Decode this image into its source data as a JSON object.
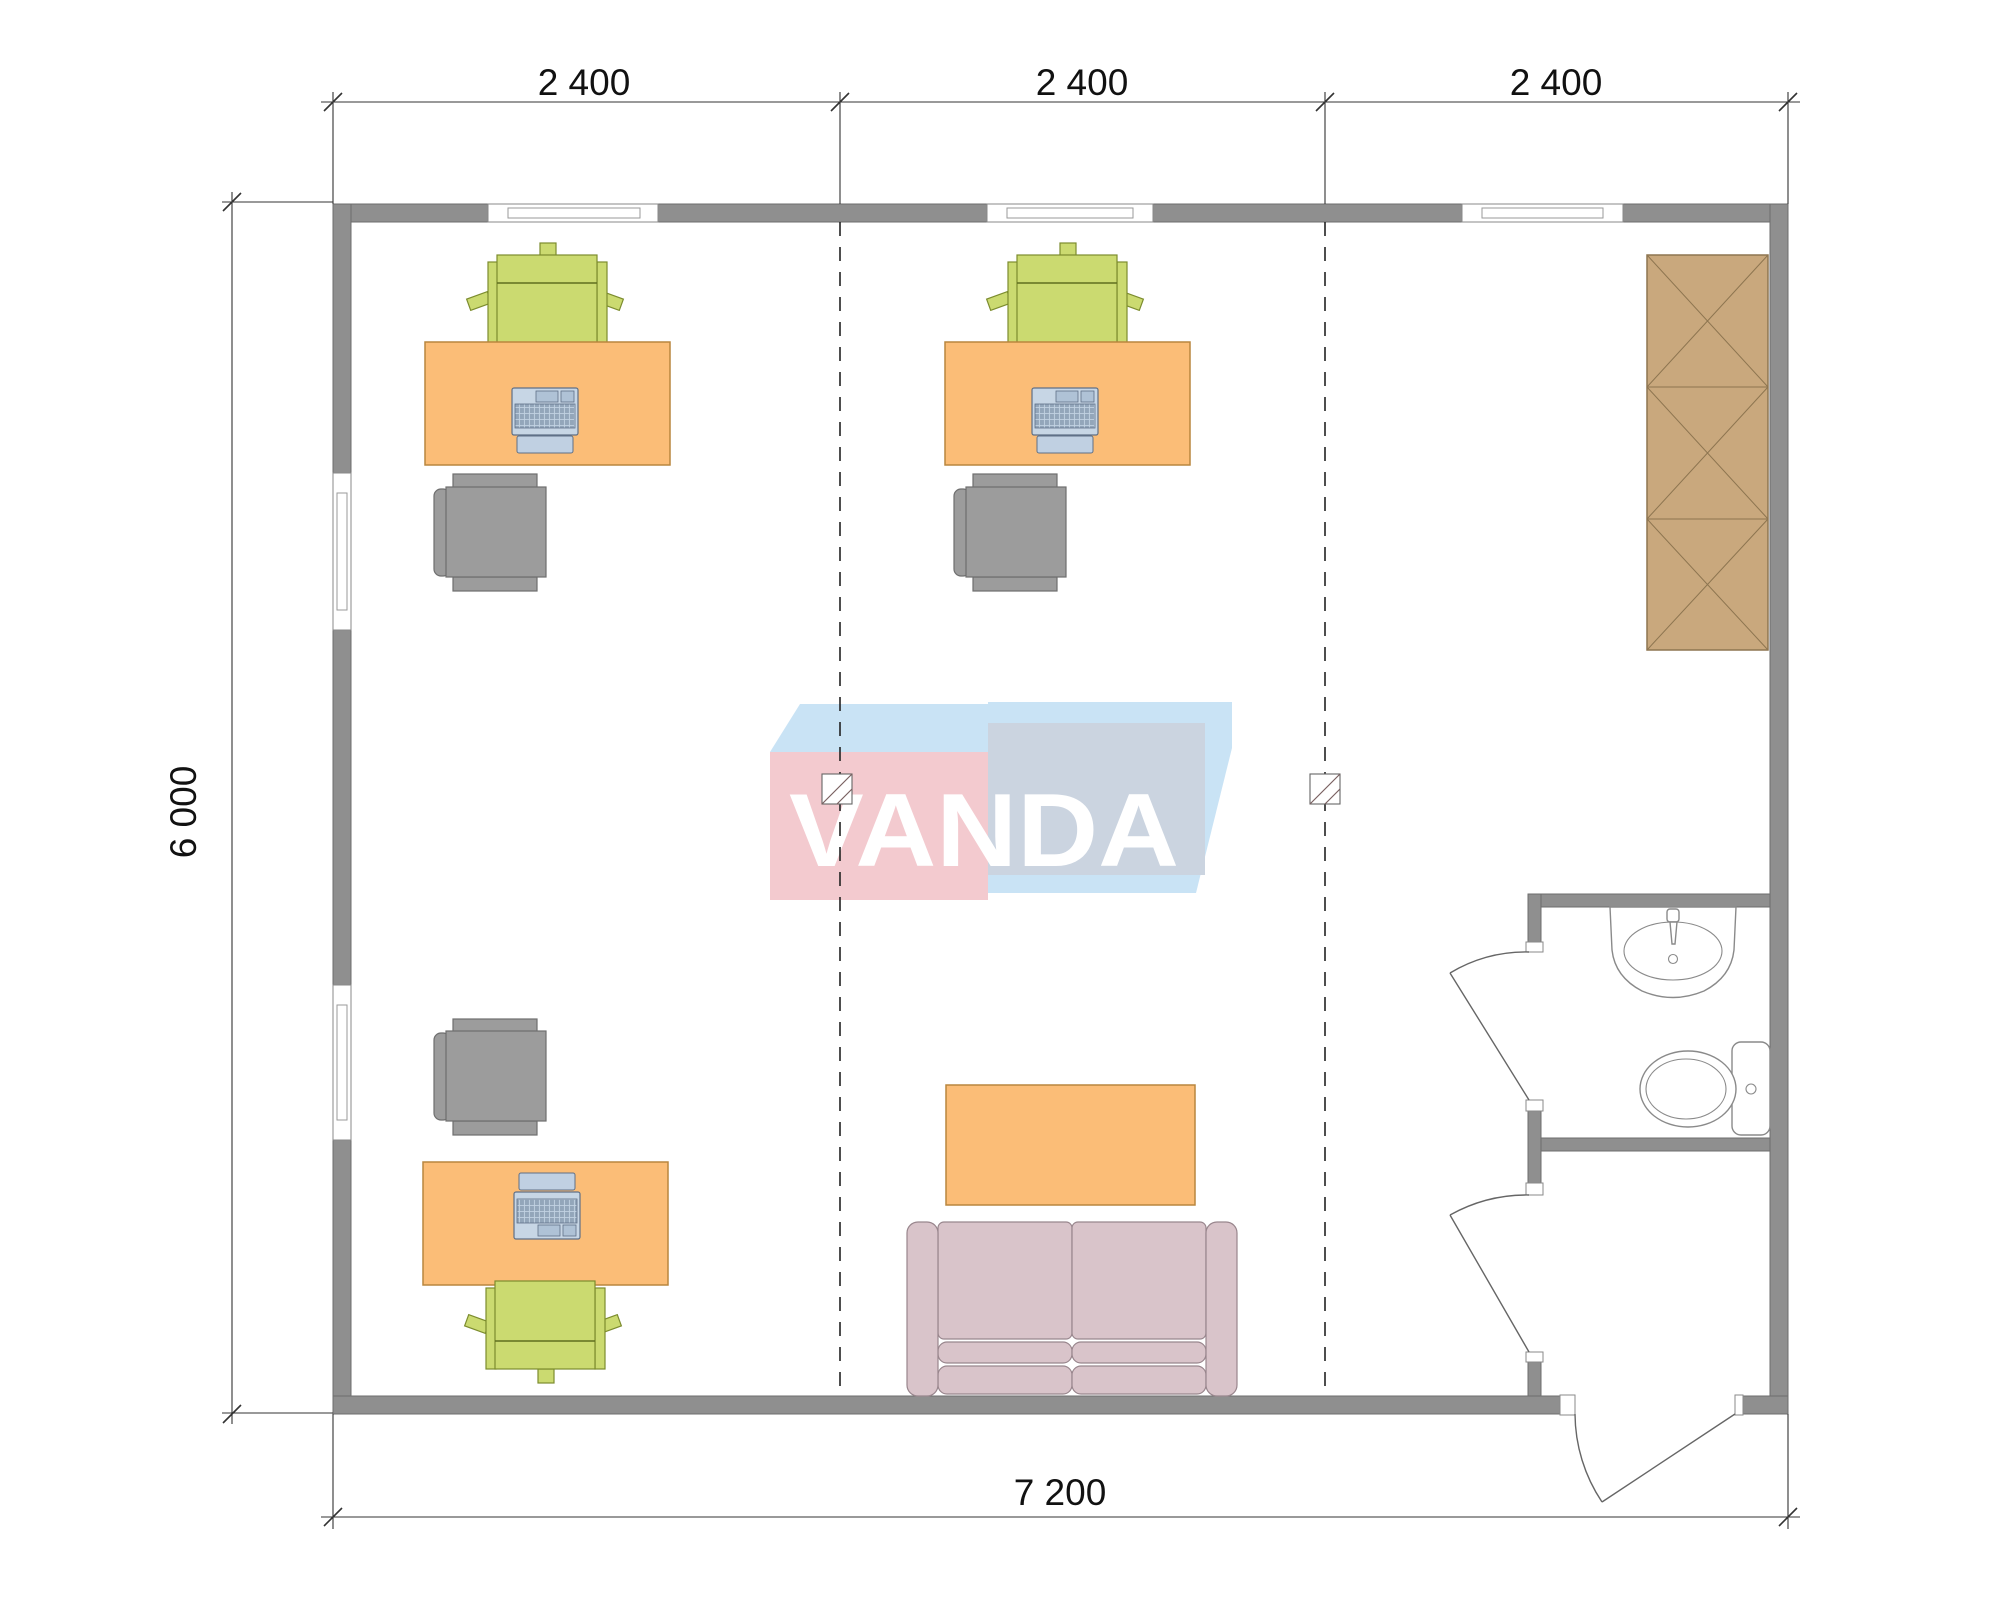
{
  "drawing": {
    "type": "architectural-floor-plan",
    "description": "office floor plan 7200 x 6000 with three bays, three workplaces, sofa zone, wardrobe and bathroom"
  },
  "dimensions": {
    "top_labels": [
      "2 400",
      "2 400",
      "2 400"
    ],
    "left_label": "6 000",
    "bottom_label": "7 200"
  },
  "watermark": {
    "text": "VANDA"
  },
  "palette": {
    "bg": "#FFFFFF",
    "wall": "#8F8F8F",
    "desk": "#FBBD77",
    "chair_green": "#CBDA70",
    "chair_gray": "#9C9C9C",
    "laptop": "#C7D6E5",
    "wardrobe": "#C9A87D",
    "sofa": "#D9C4CA",
    "logo_pink": "#F3CACF",
    "logo_blue": "#C9E3F5",
    "logo_steel": "#CBD4E0",
    "logo_letters": "#FFFFFF"
  },
  "symbols": [
    "desk-icon",
    "office-chair-icon",
    "visitor-chair-icon",
    "laptop-icon",
    "wardrobe-icon",
    "sofa-icon",
    "coffee-table-icon",
    "sink-icon",
    "toilet-icon",
    "door-swing-icon",
    "window-icon",
    "axis-marker-icon"
  ]
}
